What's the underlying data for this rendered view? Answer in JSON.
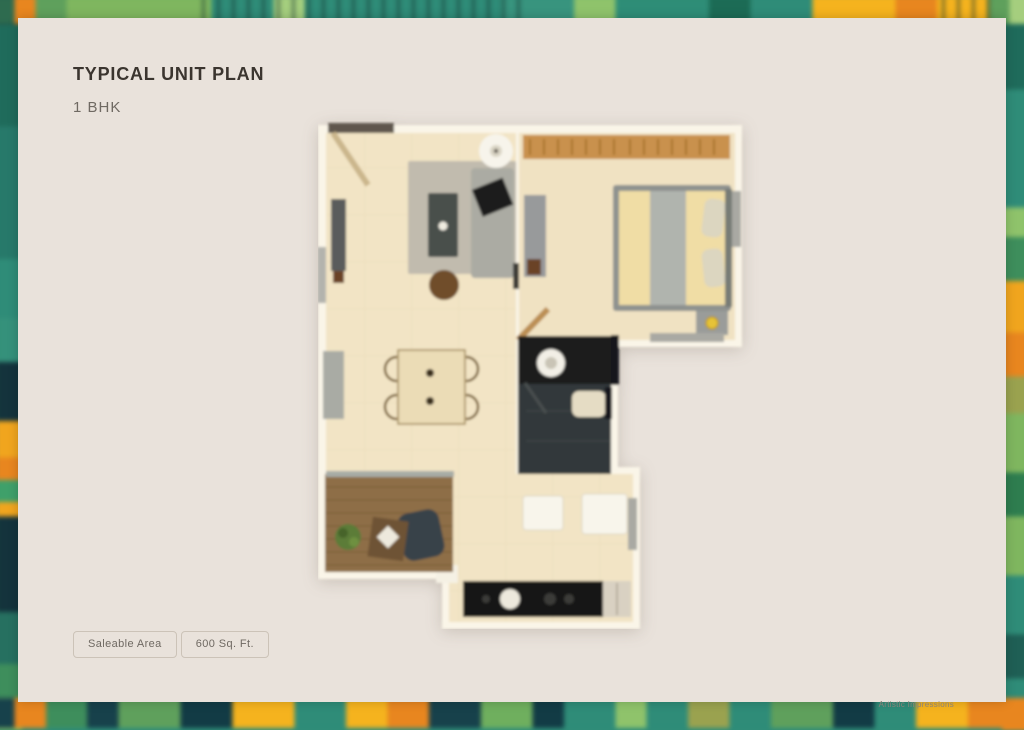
{
  "header": {
    "title": "TYPICAL UNIT PLAN",
    "subtitle": "1 BHK"
  },
  "area_info": {
    "label": "Saleable Area",
    "value": "600 Sq. Ft."
  },
  "footer": {
    "credit": "Artistic Impressions"
  },
  "floor_plan": {
    "type": "1 BHK unit top-view render",
    "rooms": [
      "living-room",
      "dining-area",
      "bedroom",
      "bathroom",
      "kitchen",
      "passage",
      "balcony"
    ]
  },
  "colors": {
    "card_bg": "#E9E2DB",
    "title_text": "#3B352F",
    "muted_text": "#6F6962",
    "wall": "#FAF5E8",
    "floor": "#F2E4C5",
    "wood_wardrobe": "#C9914D",
    "bathroom_dark": "#2C3031",
    "counter_dark": "#161613",
    "balcony_deck": "#8E6E46",
    "border_teal": "#2F8C78",
    "border_green": "#7FB65F",
    "border_yellow": "#F5B31E",
    "border_orange": "#E8861F",
    "border_navy": "#14333C"
  }
}
